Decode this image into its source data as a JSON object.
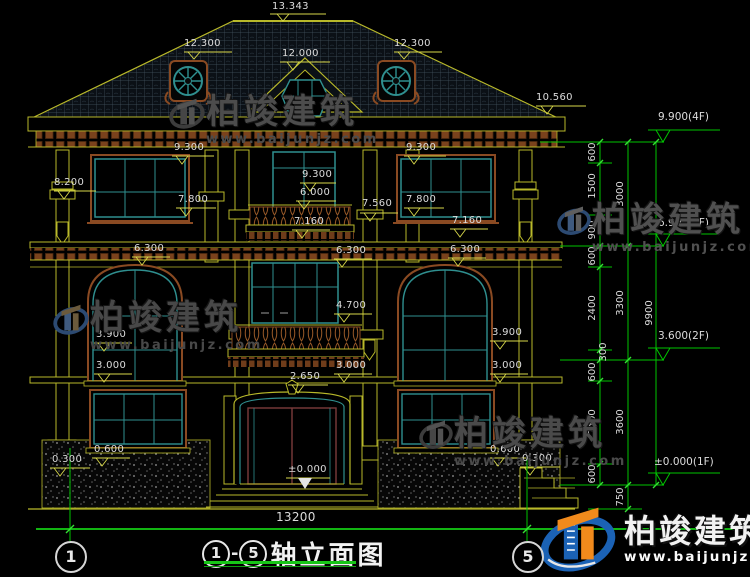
{
  "brand": {
    "name": "柏竣建筑",
    "url": "www.baijunjz.com"
  },
  "elev_marks": [
    "13.343",
    "12.300",
    "12.000",
    "12.300",
    "10.560",
    "9.300",
    "8.200",
    "7.800",
    "9.300",
    "6.000",
    "9.300",
    "7.800",
    "7.560",
    "7.160",
    "7.160",
    "6.300",
    "6.300",
    "6.300",
    "4.700",
    "3.900",
    "3.900",
    "3.000",
    "3.000",
    "3.000",
    "2.650",
    "0.600",
    "0.300",
    "±0.000",
    "0.600",
    "0.300"
  ],
  "right_dims": {
    "levels": [
      "9.900(4F)",
      "6.900(3F)",
      "3.600(2F)",
      "±0.000(1F)"
    ],
    "chain_inner": [
      "600",
      "1500",
      "900",
      "600",
      "2400",
      "300",
      "600",
      "2400",
      "600"
    ],
    "below_ground": "750",
    "chain_floors": [
      "3000",
      "3300",
      "3600"
    ],
    "chain_total": "9900"
  },
  "bottom": {
    "width_dim": "13200",
    "title": {
      "axis_start": "1",
      "dash": "-",
      "axis_end": "5",
      "text": "轴立面图"
    },
    "axis_left": "1",
    "axis_right": "5"
  }
}
